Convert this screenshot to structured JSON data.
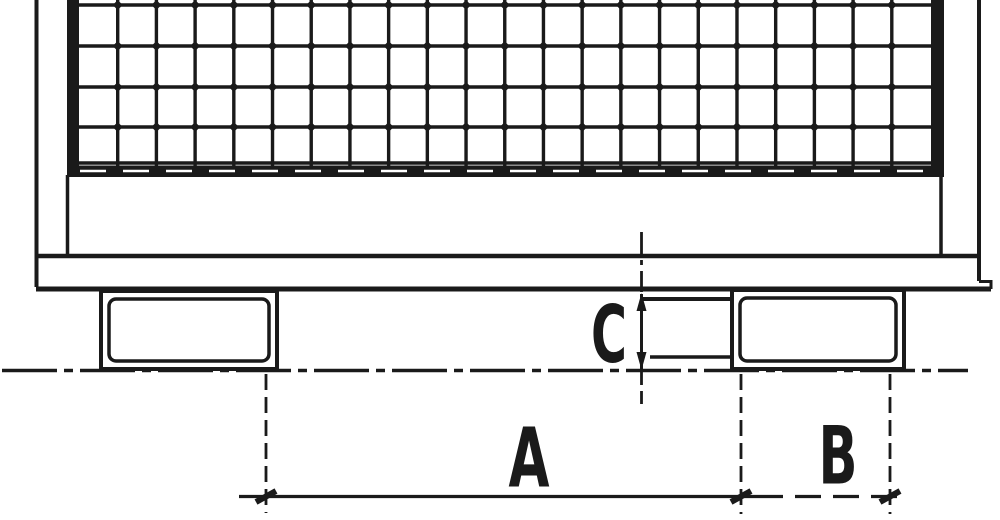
{
  "drawing": {
    "kind": "technical line drawing of a mesh-sided box pallet (side elevation) with dimension callouts",
    "labels": {
      "dim_a": "A",
      "dim_b": "B",
      "dim_c": "C"
    }
  },
  "colors": {
    "ink": "#1a1a1a",
    "paper": "#ffffff"
  }
}
